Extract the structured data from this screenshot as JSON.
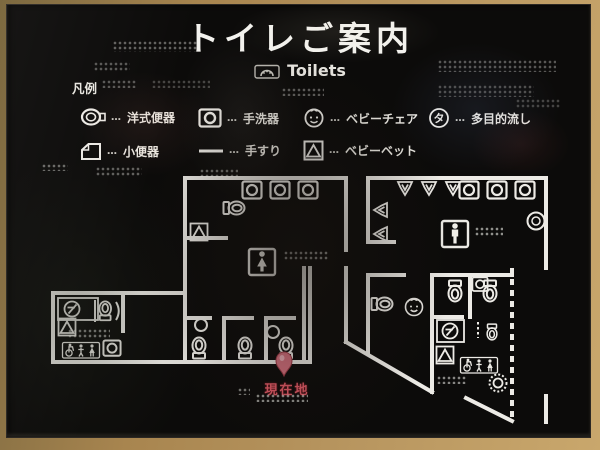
{
  "sign": {
    "title_ja": "トイレご案内",
    "title_en": "Toilets"
  },
  "legend": {
    "heading": "凡例",
    "separator": "…",
    "items": [
      {
        "label": "洋式便器",
        "icon": "western-toilet-icon"
      },
      {
        "label": "手洗器",
        "icon": "hand-wash-basin-icon"
      },
      {
        "label": "ベビーチェア",
        "icon": "baby-chair-icon"
      },
      {
        "label": "多目的流し",
        "icon": "multi-purpose-sink-icon",
        "glyph": "タ"
      },
      {
        "label": "小便器",
        "icon": "urinal-icon"
      },
      {
        "label": "手すり",
        "icon": "handrail-icon"
      },
      {
        "label": "ベビーベット",
        "icon": "baby-bed-icon"
      }
    ]
  },
  "map": {
    "you_are_here_label": "現在地"
  },
  "colors": {
    "sign_background": "#0c0b0a",
    "line_white": "#edebe6",
    "accent_red": "#df5a66",
    "frame_tan": "#b6945e"
  }
}
